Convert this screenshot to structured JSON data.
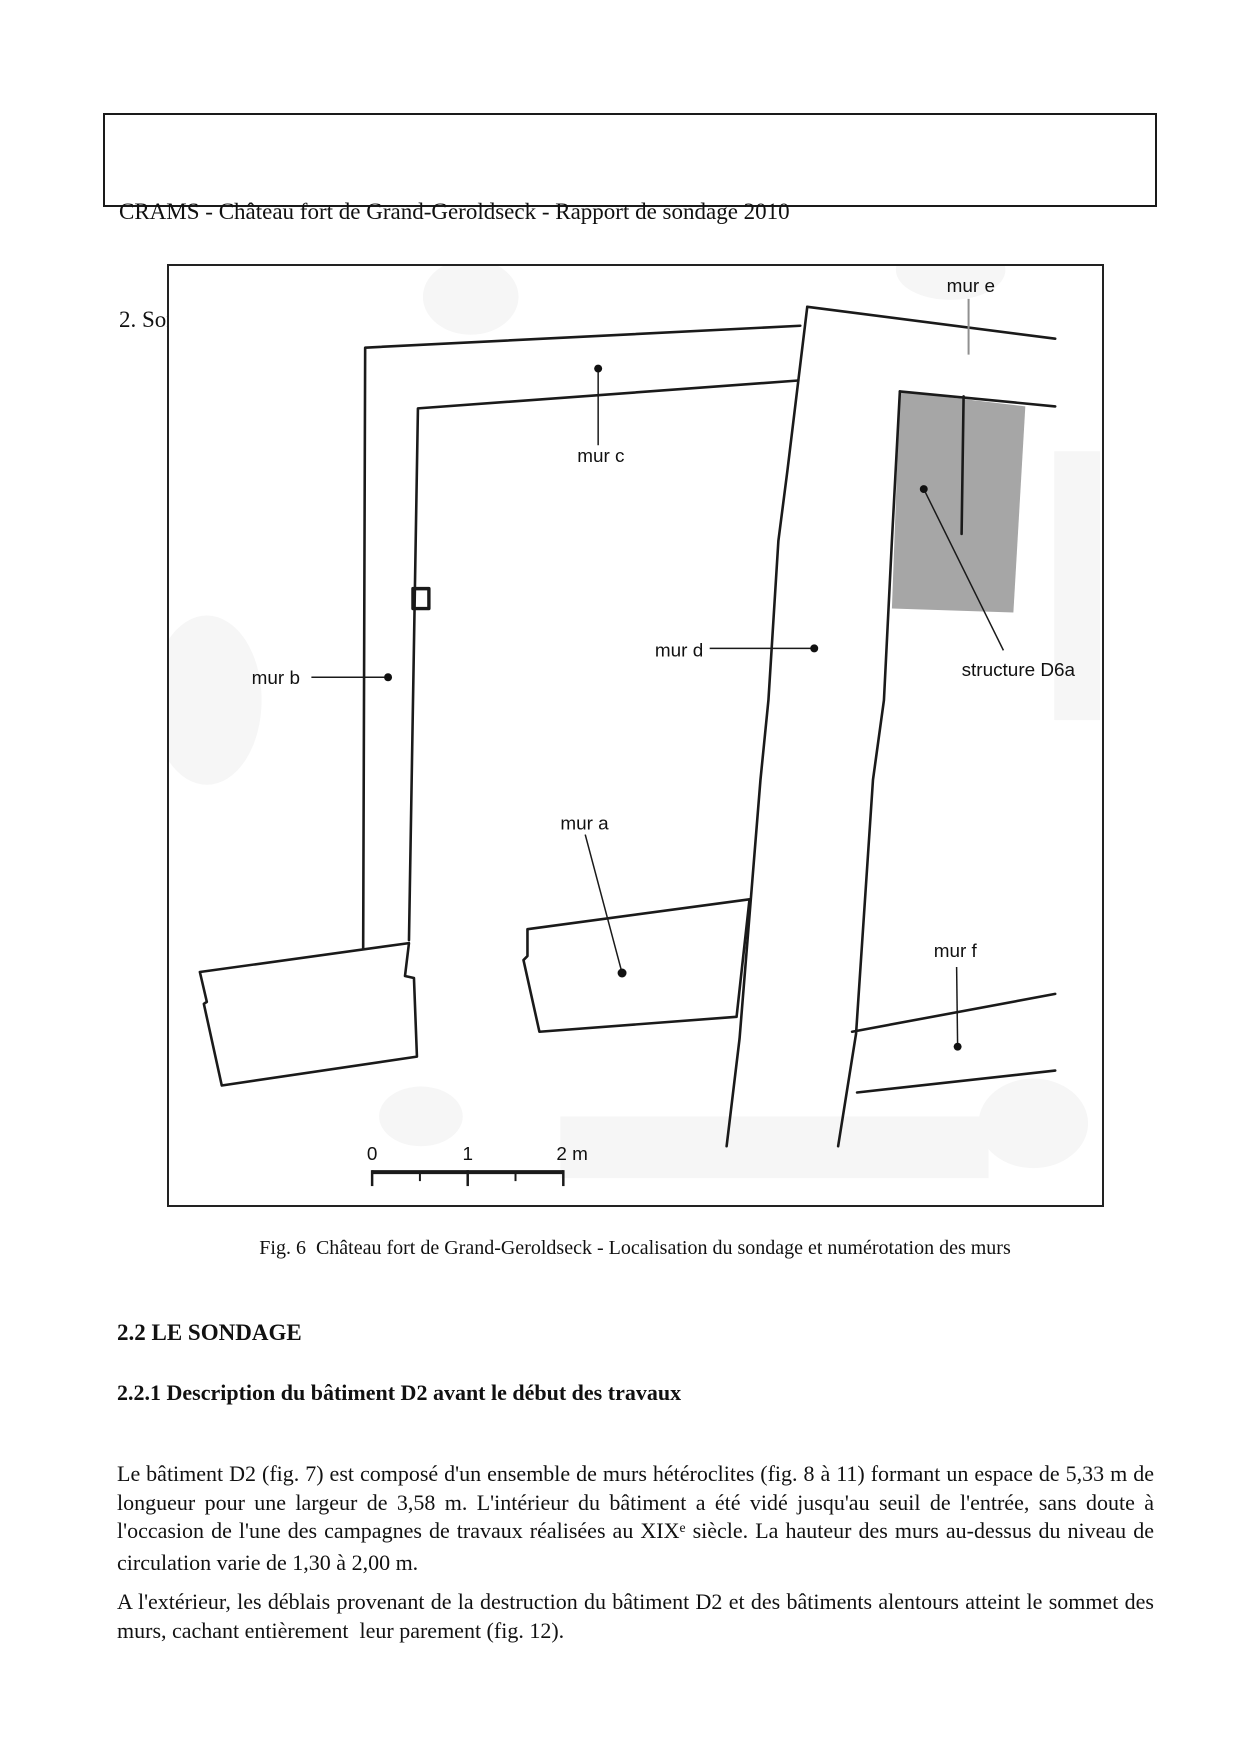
{
  "header": {
    "line1": "CRAMS - Château fort de Grand-Geroldseck - Rapport de sondage 2010",
    "line2_normal": "2. Sondage 2010  -  ",
    "line2_bold_italic": "2.1 Référentiel - 2.2 Le sondage"
  },
  "figure": {
    "labels": {
      "mur_a": "mur a",
      "mur_b": "mur b",
      "mur_c": "mur c",
      "mur_d": "mur d",
      "mur_e": "mur e",
      "mur_f": "mur f",
      "structure_d6a": "structure D6a"
    },
    "scale": {
      "t0": "0",
      "t1": "1",
      "t2": "2 m"
    },
    "gray_fill": "#a6a6a6",
    "line_color": "#1a1a1a",
    "caption": "Fig. 6  Château fort de Grand-Geroldseck - Localisation du sondage et numérotation des murs"
  },
  "sections": {
    "h1": "2.2 LE SONDAGE",
    "h2": "2.2.1 Description du bâtiment D2 avant le début des travaux"
  },
  "paragraphs": {
    "p1_before_sup": "Le bâtiment D2 (fig. 7) est composé d'un ensemble de murs hétéroclites (fig. 8 à 11) formant un espace de 5,33 m de longueur pour une largeur de 3,58 m. L'intérieur du bâtiment a été vidé jusqu'au seuil de l'entrée, sans doute à l'occasion de l'une des campagnes de travaux réalisées au XIX",
    "p1_sup": "e",
    "p1_after_sup": " siècle. La hauteur des murs au-dessus du niveau de circulation varie de 1,30 à 2,00 m.",
    "p2": "A l'extérieur, les déblais provenant de la destruction du bâtiment D2 et des bâtiments alentours atteint le sommet des murs, cachant entièrement  leur parement (fig. 12)."
  }
}
